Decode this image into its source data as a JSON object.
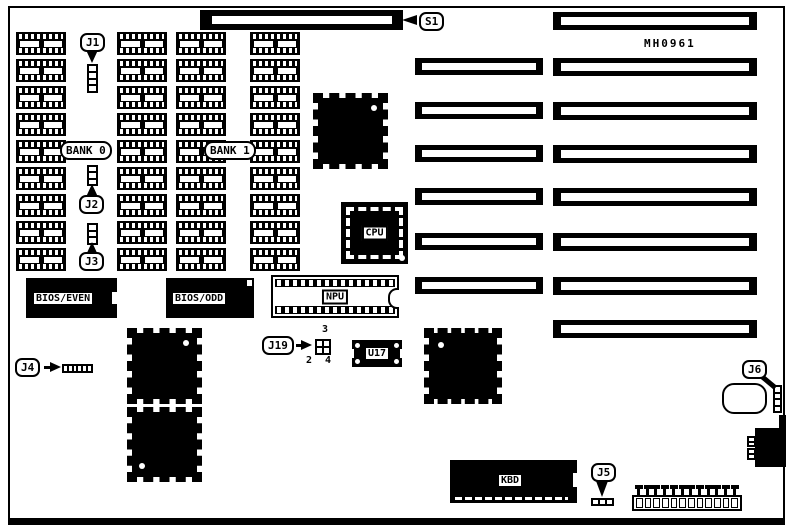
{
  "diagram": {
    "part_number": "MH0961",
    "ink": "#000000",
    "paper": "#ffffff"
  },
  "slots": {
    "s1_label": "S1",
    "short_slot_count": 6,
    "long_slot_count": 8
  },
  "memory": {
    "columns": 4,
    "rows": 9,
    "bank_labels": [
      "BANK 0",
      "BANK 1"
    ]
  },
  "chips": {
    "cpu_label": "CPU",
    "npu_label": "NPU",
    "u17_label": "U17",
    "bios_even_label": "BIOS/EVEN",
    "bios_odd_label": "BIOS/ODD",
    "kbd_label": "KBD"
  },
  "jumpers": {
    "j1": {
      "label": "J1",
      "pins": 4
    },
    "j2": {
      "label": "J2",
      "pins": 3
    },
    "j3": {
      "label": "J3",
      "pins": 3
    },
    "j4": {
      "label": "J4",
      "pins": 6
    },
    "j5": {
      "label": "J5",
      "pins": 3
    },
    "j6": {
      "label": "J6",
      "pins": 4
    },
    "j19": {
      "label": "J19",
      "pins": 4,
      "pin_labels": {
        "top_right": "3",
        "bottom_left": "2",
        "bottom_right": "4"
      }
    }
  },
  "power": {
    "pins": 12
  }
}
